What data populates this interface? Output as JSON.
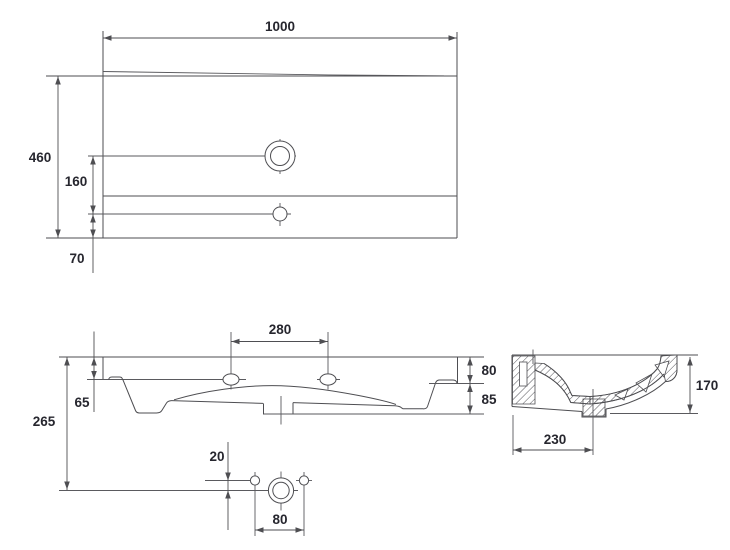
{
  "colors": {
    "line": "#4e4e52",
    "text": "#26262e",
    "background": "#ffffff"
  },
  "views": {
    "plan": {
      "dims": {
        "width": "1000",
        "depth": "460",
        "tap_hole_offset": "160",
        "back_offset": "70"
      }
    },
    "front": {
      "dims": {
        "tap_spacing": "280",
        "left_rim": "65",
        "total_height": "265",
        "right_rim": "80",
        "right_bowl": "85"
      }
    },
    "drain_detail": {
      "dims": {
        "hole_offset": "20",
        "hole_spacing": "80"
      }
    },
    "section": {
      "dims": {
        "height": "170",
        "drain_offset": "230"
      }
    }
  }
}
